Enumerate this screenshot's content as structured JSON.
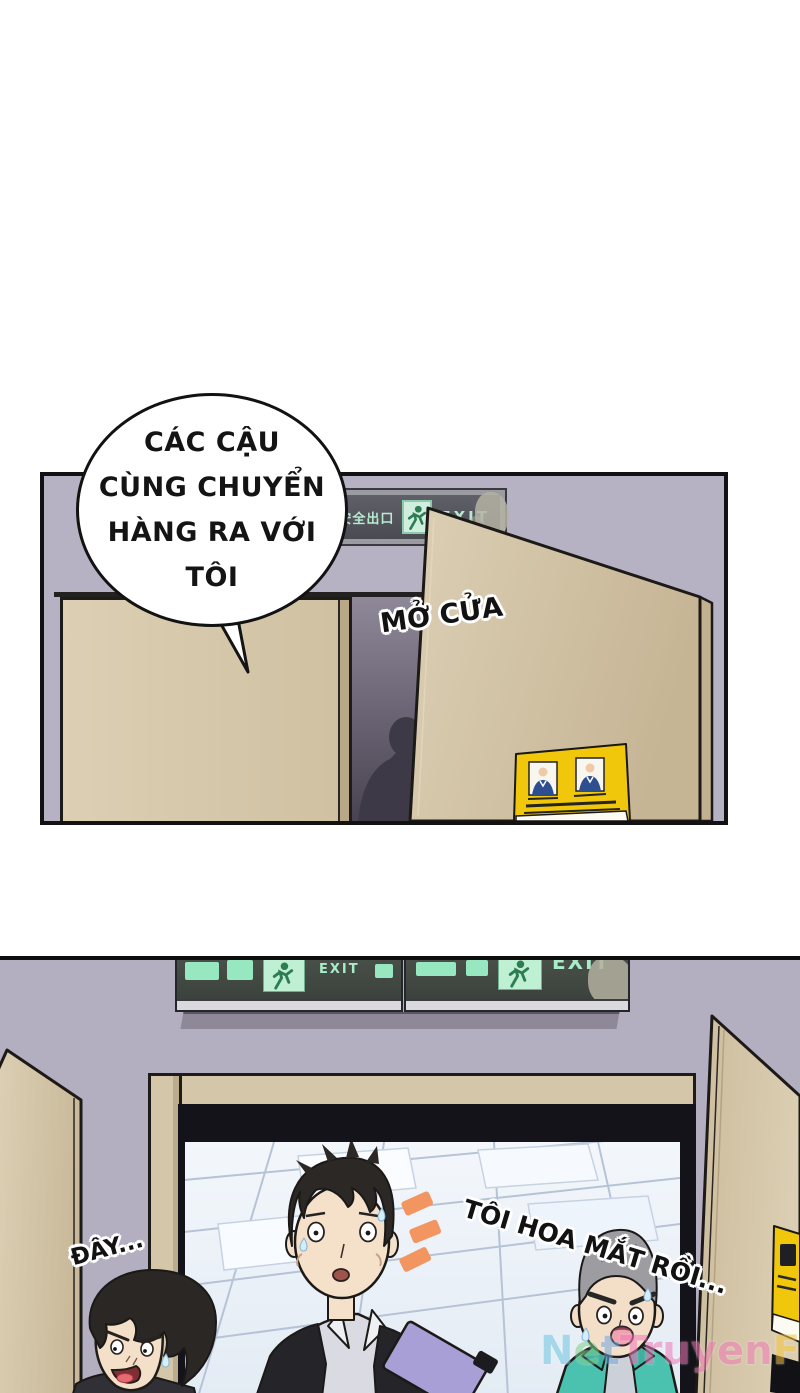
{
  "panel1": {
    "speech_bubble": {
      "lines": [
        "CÁC CẬU",
        "CÙNG CHUYỂN",
        "HÀNG RA VỚI",
        "TÔI"
      ]
    },
    "sfx_open_door": "MỞ CỬA",
    "exit_sign": {
      "cn": "安全出口",
      "en": "EXIT"
    },
    "door_warning_sign": {
      "cn_top": "安全出口",
      "en_top": "EXIT",
      "cn_bottom": "请勿阻塞",
      "en_bottom": "Please Do Not Block"
    }
  },
  "panel2": {
    "sfx_here": "ĐÂY...",
    "sfx_dizzy": "TÔI HOA MẮT RỒI...",
    "exit_sign_en": "EXIT",
    "watermark": {
      "text": "NetTruyenFE",
      "letter_colors": [
        "#6ec6e0",
        "#7fd08a",
        "#6ea8e0",
        "#f27ab8",
        "#f27ab8",
        "#f27ab8",
        "#f27ab8",
        "#f27ab8",
        "#f27ab8",
        "#f5c63e",
        "#f5c63e"
      ]
    }
  },
  "colors": {
    "wall": "#b6b1c3",
    "door_tan": "#d5c7aa",
    "sign_yellow": "#f2ca08",
    "exit_green": "#9fe8c0",
    "emphasis_orange": "#f29560",
    "jacket_teal": "#4bc2b0",
    "clipboard_purple": "#a89fd6"
  }
}
